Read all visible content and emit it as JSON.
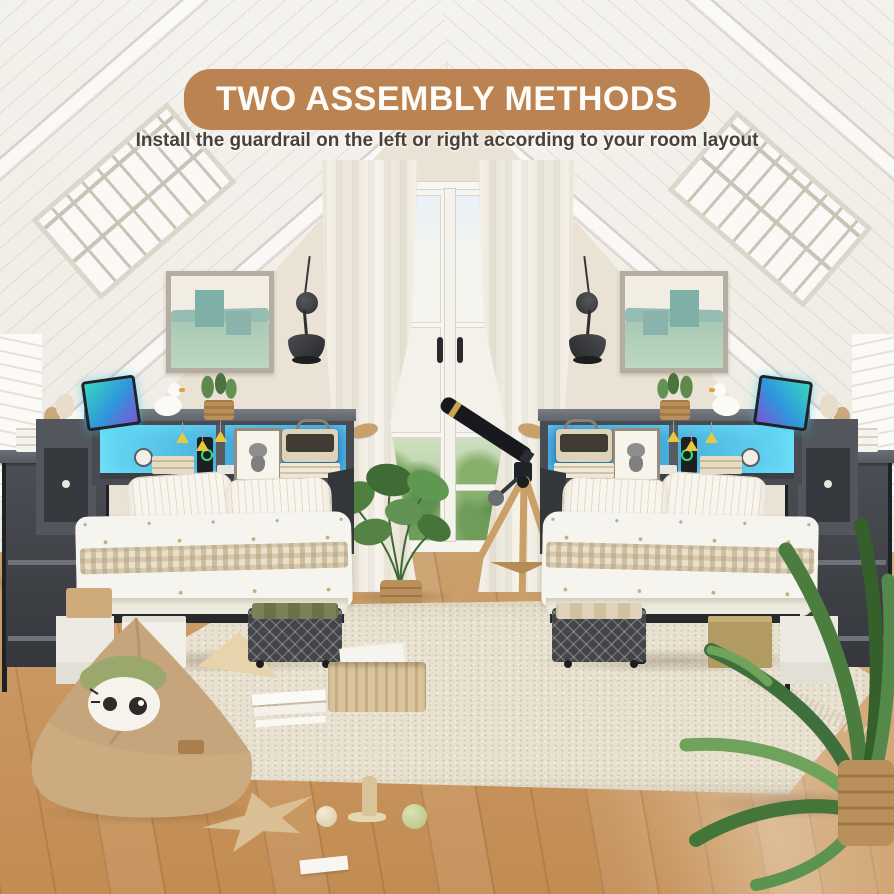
{
  "banner": {
    "title": "TWO ASSEMBLY METHODS",
    "subtitle": "Install the guardrail on the left or right according to your room layout"
  },
  "scene_labels": {
    "speaker_brand_left": "Marshall",
    "speaker_brand_right": "Marshall"
  },
  "colors": {
    "banner_bg": "#bc8352",
    "banner_text": "#fdfcf8",
    "subtitle_text": "#49423a",
    "led_a": "#67dcf6",
    "led_b": "#2a7fc2",
    "led_ring": "#35e07a",
    "cone_yellow": "#e9c93c",
    "wall": "#eae2d4",
    "ceiling_light": "#f5f3ee",
    "ceiling_shade": "#edeae2",
    "floor_wood": "#c8955e",
    "rug_base": "#e8e1cf",
    "headboard": "#4a4e54",
    "frame_dark": "#26282c",
    "bedding": "#f6f4ee",
    "gingham": "#e9dfc8",
    "teal": "#7fb0a8",
    "wood_light": "#c9a068",
    "beanbag": "#c6a57c",
    "plant_green": "#548343"
  }
}
